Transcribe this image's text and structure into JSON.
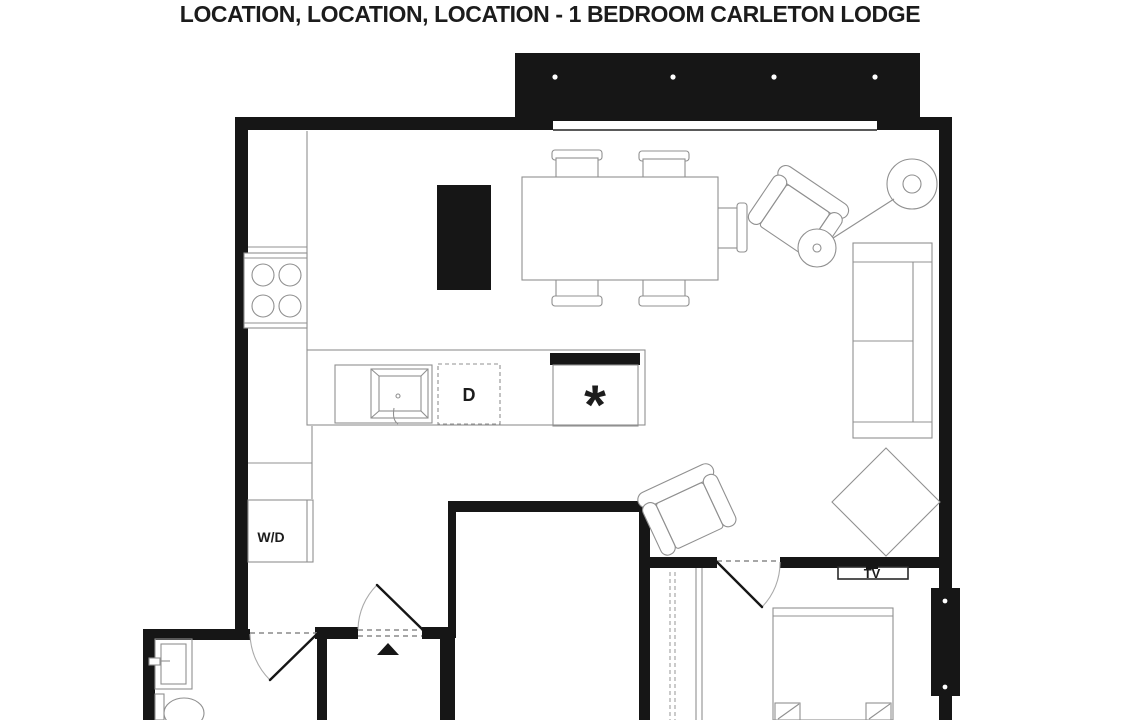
{
  "title": "LOCATION, LOCATION, LOCATION - 1 BEDROOM CARLETON LODGE",
  "plan": {
    "labels": {
      "washer_dryer": "W/D",
      "dishwasher": "D",
      "tv": "TV",
      "appliance_symbol": "*"
    },
    "balcony_posts": 4,
    "patio_marker_posts": 2
  },
  "colors": {
    "walls": "#161616",
    "furniture_lines": "#909090",
    "background": "#ffffff",
    "text": "#1c1c1c"
  }
}
